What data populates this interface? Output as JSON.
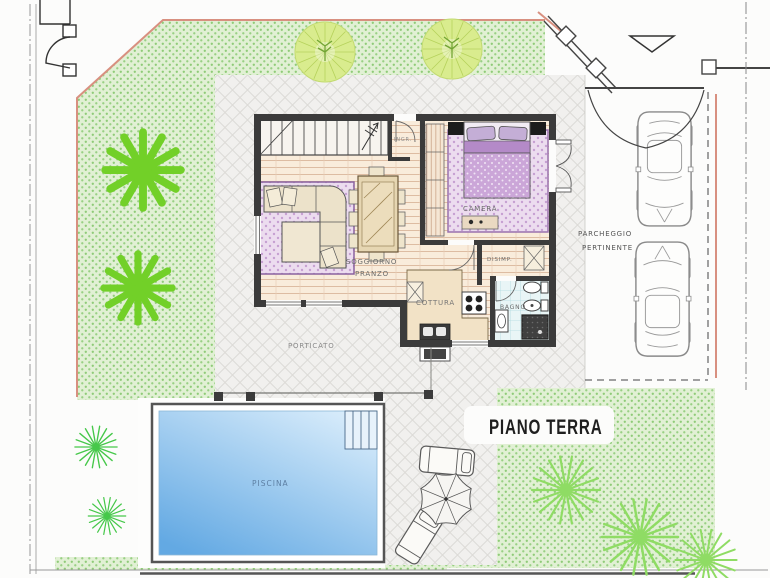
{
  "title": {
    "text": "PIANO TERRA"
  },
  "rooms": {
    "camera": "CAMERA",
    "soggiorno_1": "SOGGIORNO",
    "soggiorno_2": "PRANZO",
    "cottura": "COTTURA",
    "bagno": "BAGNO",
    "disimpegno": "DISIMP.",
    "ingresso": "INGR.",
    "porticato": "PORTICATO",
    "piscina": "PISCINA"
  },
  "outdoor": {
    "parcheggio_1": "PARCHEGGIO",
    "parcheggio_2": "PERTINENTE"
  },
  "colors": {
    "boundary_red": "#d89080",
    "wall": "#3b3b3b",
    "grass_dot": "#8fcb78",
    "water_light": "#d8ecfb",
    "water_deep": "#63a9e3",
    "tree_palm": "#72d028",
    "tree_needle": "#8fdc64",
    "bush": "#46c84a",
    "tree_round": "#d7ec8a",
    "rug_dot": "#c6a0d2",
    "title_ink": "#1f1f1f",
    "label_ink": "#6b6b6b"
  }
}
